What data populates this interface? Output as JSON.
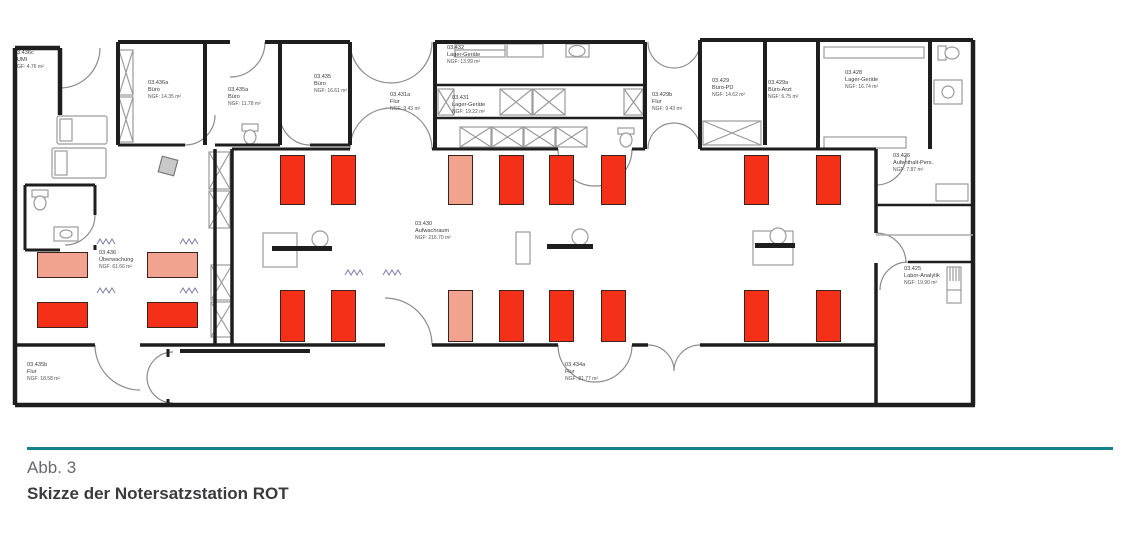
{
  "caption": {
    "figure": "Abb. 3",
    "title": "Skizze der Notersatzstation ROT"
  },
  "colors": {
    "red": "#f43018",
    "salmon": "#f2a38f",
    "bed_border": "#3a231c",
    "divider_teal": "#15818f",
    "wall": "#1e1e1e"
  },
  "rooms": [
    {
      "id": "3.436c",
      "name": "UMI",
      "area": "GF: 4.76 m²",
      "x": 17,
      "y": 50
    },
    {
      "id": "03.436a",
      "name": "Büro",
      "area": "NGF: 14.35 m²",
      "x": 148,
      "y": 80
    },
    {
      "id": "03.435a",
      "name": "Büro",
      "area": "NGF: 11.78 m²",
      "x": 228,
      "y": 87
    },
    {
      "id": "03.435",
      "name": "Büro",
      "area": "NGF: 16.61 m²",
      "x": 314,
      "y": 74
    },
    {
      "id": "03.432",
      "name": "Lager-Geräte",
      "area": "NGF: 13.99 m²",
      "x": 447,
      "y": 45
    },
    {
      "id": "03.431a",
      "name": "Flur",
      "area": "NGF: 9.43 m²",
      "x": 390,
      "y": 92
    },
    {
      "id": "03.431",
      "name": "Lager-Geräte",
      "area": "NGF: 19.22 m²",
      "x": 452,
      "y": 95
    },
    {
      "id": "03.429b",
      "name": "Flur",
      "area": "NGF: 9.43 m²",
      "x": 652,
      "y": 92
    },
    {
      "id": "03.429",
      "name": "Büro-PD",
      "area": "NGF: 14.62 m²",
      "x": 712,
      "y": 78
    },
    {
      "id": "03.429a",
      "name": "Büro-Arzt",
      "area": "NGF: 6.75 m²",
      "x": 768,
      "y": 80
    },
    {
      "id": "03.428",
      "name": "Lager-Geräte",
      "area": "NGF: 16.74 m²",
      "x": 845,
      "y": 70
    },
    {
      "id": "03.426",
      "name": "Aufenthalt-Pers.",
      "area": "NGF: 7.87 m²",
      "x": 893,
      "y": 153
    },
    {
      "id": "03.425",
      "name": "Labor-Analytik",
      "area": "NGF: 19.90 m²",
      "x": 904,
      "y": 266
    },
    {
      "id": "03.430",
      "name": "Aufwachraum",
      "area": "NGF: 216.70 m²",
      "x": 415,
      "y": 221
    },
    {
      "id": "03.436",
      "name": "Überwachung",
      "area": "NGF: 61.66 m²",
      "x": 99,
      "y": 250
    },
    {
      "id": "03.435b",
      "name": "Flur",
      "area": "NGF: 18.58 m²",
      "x": 27,
      "y": 362
    },
    {
      "id": "03.434a",
      "name": "Flur",
      "area": "NGF: 81.77 m²",
      "x": 565,
      "y": 362
    }
  ],
  "beds": [
    {
      "x": 280,
      "y": 155,
      "w": 25,
      "h": 50,
      "color": "red"
    },
    {
      "x": 331,
      "y": 155,
      "w": 25,
      "h": 50,
      "color": "red"
    },
    {
      "x": 448,
      "y": 155,
      "w": 25,
      "h": 50,
      "color": "salmon"
    },
    {
      "x": 499,
      "y": 155,
      "w": 25,
      "h": 50,
      "color": "red"
    },
    {
      "x": 549,
      "y": 155,
      "w": 25,
      "h": 50,
      "color": "red"
    },
    {
      "x": 601,
      "y": 155,
      "w": 25,
      "h": 50,
      "color": "red"
    },
    {
      "x": 744,
      "y": 155,
      "w": 25,
      "h": 50,
      "color": "red"
    },
    {
      "x": 816,
      "y": 155,
      "w": 25,
      "h": 50,
      "color": "red"
    },
    {
      "x": 280,
      "y": 290,
      "w": 25,
      "h": 52,
      "color": "red"
    },
    {
      "x": 331,
      "y": 290,
      "w": 25,
      "h": 52,
      "color": "red"
    },
    {
      "x": 448,
      "y": 290,
      "w": 25,
      "h": 52,
      "color": "salmon"
    },
    {
      "x": 499,
      "y": 290,
      "w": 25,
      "h": 52,
      "color": "red"
    },
    {
      "x": 549,
      "y": 290,
      "w": 25,
      "h": 52,
      "color": "red"
    },
    {
      "x": 601,
      "y": 290,
      "w": 25,
      "h": 52,
      "color": "red"
    },
    {
      "x": 744,
      "y": 290,
      "w": 25,
      "h": 52,
      "color": "red"
    },
    {
      "x": 816,
      "y": 290,
      "w": 25,
      "h": 52,
      "color": "red"
    },
    {
      "x": 37,
      "y": 252,
      "w": 51,
      "h": 26,
      "color": "salmon"
    },
    {
      "x": 147,
      "y": 252,
      "w": 51,
      "h": 26,
      "color": "salmon"
    },
    {
      "x": 37,
      "y": 302,
      "w": 51,
      "h": 26,
      "color": "red"
    },
    {
      "x": 147,
      "y": 302,
      "w": 51,
      "h": 26,
      "color": "red"
    }
  ]
}
